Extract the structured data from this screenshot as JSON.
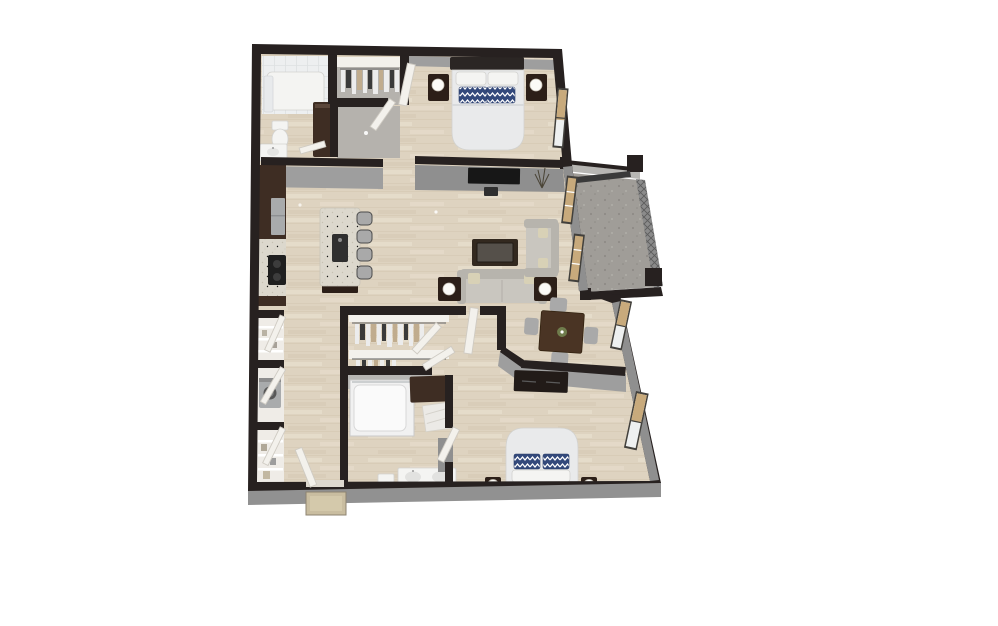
{
  "scene": {
    "type": "3d-floor-plan-render",
    "view": "top-down-isometric",
    "background": "white",
    "unit_summary": {
      "bedrooms": 2,
      "bathrooms": 2,
      "walk_in_closets": 2,
      "balcony": true
    },
    "rooms": [
      {
        "name": "primary-bathroom",
        "furniture": [
          "tiled-shower-tub",
          "shower-curtain",
          "toilet",
          "vanity-sink",
          "towel-rack",
          "linen-cabinet"
        ]
      },
      {
        "name": "primary-walk-in-closet",
        "furniture": [
          "shelf-band",
          "hanging-rod",
          "hanging-clothes"
        ]
      },
      {
        "name": "primary-bedroom",
        "furniture": [
          "bed-with-navy-chevron-pillows",
          "headboard",
          "nightstand-left",
          "nightstand-right",
          "table-lamp-left",
          "table-lamp-right",
          "window-with-tan-blinds"
        ]
      },
      {
        "name": "interior-hallway",
        "furniture": [
          "ceiling-light"
        ]
      },
      {
        "name": "kitchen",
        "furniture": [
          "tall-cabinets",
          "refrigerator",
          "counter-with-cooktop",
          "island-with-sink",
          "bar-stools-x4"
        ]
      },
      {
        "name": "living-room",
        "furniture": [
          "wall-mounted-tv",
          "media-box",
          "sofa",
          "loveseat",
          "coffee-table",
          "end-table-left",
          "end-table-right",
          "table-lamps",
          "corner-plant"
        ]
      },
      {
        "name": "dining-area",
        "furniture": [
          "dining-table",
          "dining-chairs-x4",
          "centerpiece-plant"
        ]
      },
      {
        "name": "balcony",
        "furniture": [
          "concrete-floor",
          "mesh-railing",
          "corner-posts",
          "overhead-beam"
        ]
      },
      {
        "name": "entry-hall",
        "furniture": [
          "pantry-closet",
          "laundry-closet-with-washer",
          "storage-closet",
          "closet-doors-x3",
          "entry-door",
          "entry-step-mat"
        ]
      },
      {
        "name": "second-walk-in-closet",
        "furniture": [
          "double-hanging-rods",
          "hanging-clothes",
          "shelf-bands",
          "bifold-doors"
        ]
      },
      {
        "name": "second-bathroom",
        "furniture": [
          "tub-shower",
          "linen-cabinet",
          "open-shelves",
          "toilet",
          "double-vanity",
          "vanity-light-dots",
          "mirror-panel"
        ]
      },
      {
        "name": "second-bedroom",
        "furniture": [
          "dresser",
          "bed-with-navy-chevron-pillows",
          "headboard",
          "nightstand-left",
          "nightstand-right",
          "table-lamps",
          "windows-with-tan-blinds"
        ]
      }
    ]
  },
  "colors": {
    "floor-wood": "#ded3c0",
    "floor-line": "#cfc2aa",
    "floor-streak": "#e9e0cf",
    "wall-dark": "#272120",
    "wall-face": "#9e9e9e",
    "wall-face-dark": "#8f8f8f",
    "wall-face-light": "#b7b6b3",
    "shadow-floor": "#b5b2ad",
    "slab": "#919191",
    "concrete": "#a09d98",
    "concrete-dot": "#8e8b86",
    "concrete-dot2": "#aeaba5",
    "mesh-base": "#8b8b8b",
    "mesh-line": "#5d5d5d",
    "cabinet-brown": "#3e2d23",
    "cabinet-brown-dark": "#2c1f18",
    "counter-speckle": "#dcd8cd",
    "speckle-dot": "#c6c1b2",
    "white-fixture": "#f4f4f2",
    "fixture-line": "#d2d2cf",
    "tile": "#edeff0",
    "tile-line": "#dde1e2",
    "sofa": "#c9c6bf",
    "sofa-dark": "#b7b4ad",
    "pillow-navy": "#33497b",
    "pillow-cream": "#d8d1b6",
    "bed-white": "#e9eaeb",
    "bed-shade": "#dfe1e3",
    "wood-table": "#4a3424",
    "chair-gray": "#a9a9a9",
    "door-white": "#f3f1ec",
    "door-edge": "#cfcbc3",
    "window-tan": "#c8aa7c",
    "window-frame": "#42403c",
    "glass-white": "#eef0f0",
    "appliance-gray": "#a9abac",
    "tv-black": "#171717",
    "lamp-white": "#fbfaf6",
    "mat": "#c9bda0",
    "mat-inner": "#d4c9ab",
    "mat-edge": "#8d8371",
    "clothes-light": "#ececec",
    "clothes-dark": "#3a3a3a",
    "clothes-tan": "#c0ac8e",
    "plant-green": "#6f7c4c"
  }
}
